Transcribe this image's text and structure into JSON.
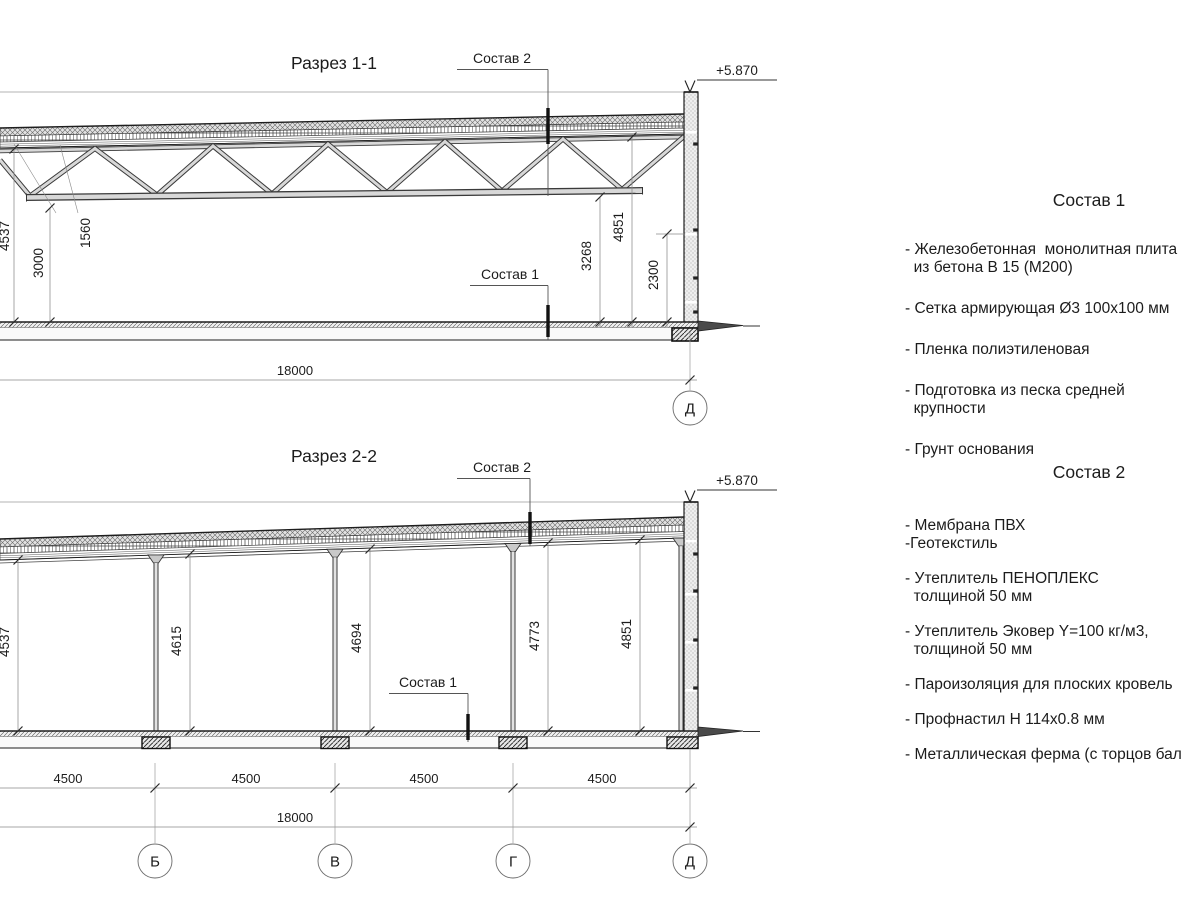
{
  "drawing": {
    "section1": {
      "title": "Разрез 1-1",
      "composition2_label": "Состав 2",
      "composition1_label": "Состав 1",
      "elevation_mark": "+5.870",
      "dim_total_height": "4537",
      "dim_truss_height": "1560",
      "dim_clear_height": "3000",
      "dim_bottom_chord_height": "3268",
      "dim_deck_height": "4851",
      "dim_wall_mark_height": "2300",
      "dim_total_length": "18000",
      "axis_label": "Д"
    },
    "section2": {
      "title": "Разрез 2-2",
      "composition2_label": "Состав 2",
      "composition1_label": "Состав 1",
      "elevation_mark": "+5.870",
      "dim_heights": [
        "4537",
        "4615",
        "4694",
        "4773",
        "4851"
      ],
      "dim_spacings": [
        "4500",
        "4500",
        "4500",
        "4500"
      ],
      "dim_total_length": "18000",
      "axis_labels": [
        "Б",
        "В",
        "Г",
        "Д"
      ]
    }
  },
  "notes": {
    "composition1": {
      "title": "Состав 1",
      "items": [
        "- Железобетонная  монолитная плита\n  из бетона В 15 (М200)",
        "- Сетка армирующая Ø3 100х100 мм",
        "- Пленка полиэтиленовая",
        "- Подготовка из песка средней\n  крупности",
        "- Грунт основания"
      ]
    },
    "composition2": {
      "title": "Состав 2",
      "items": [
        "- Мембрана ПВХ\n-Геотекстиль",
        "- Утеплитель ПЕНОПЛЕКС\n  толщиной 50 мм",
        "- Утеплитель Эковер Y=100 кг/м3,\n  толщиной 50 мм",
        "- Пароизоляция для плоских кровель",
        "- Профнастил Н 114х0.8 мм",
        "- Металлическая ферма (с торцов бал"
      ]
    }
  }
}
